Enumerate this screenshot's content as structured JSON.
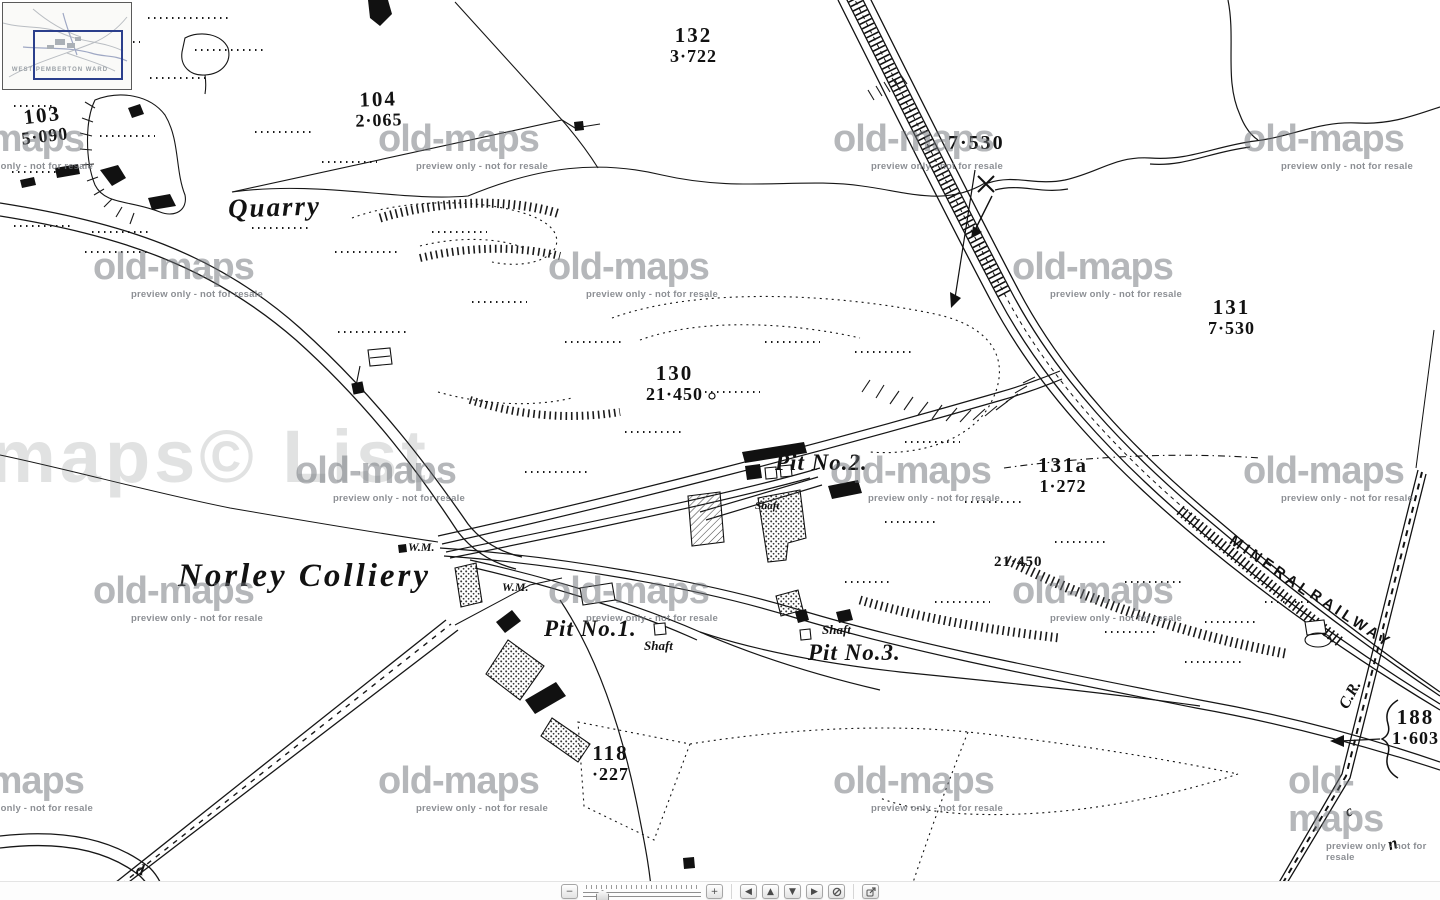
{
  "inset": {
    "caption": "WEST PEMBERTON WARD"
  },
  "watermarks": {
    "tile_text": "old-maps",
    "tile_caption": "preview only - not for resale",
    "giant_text": "maps© List"
  },
  "labels": {
    "quarry": "Quarry",
    "colliery": "Norley Colliery",
    "pit1": "Pit No.1.",
    "pit2": "Pit No.2.",
    "pit3": "Pit No.3.",
    "shaft": "Shaft",
    "wm": "W.M.",
    "mineral": "MINERAL",
    "railway": "RAILWAY",
    "cr": "C.R.",
    "rail_value": "7·530",
    "tip_value": "21·450",
    "letter_d": "d",
    "letter_c": "c",
    "letter_n": "n"
  },
  "parcels": [
    {
      "number": "132",
      "area": "3·722"
    },
    {
      "number": "104",
      "area": "2·065"
    },
    {
      "number": "103",
      "area": "5·090"
    },
    {
      "number": "131",
      "area": "7·530"
    },
    {
      "number": "130",
      "area": "21·450"
    },
    {
      "number": "131a",
      "area": "1·272"
    },
    {
      "number": "118",
      "area": "·227"
    },
    {
      "number": "188",
      "area": "1·603"
    }
  ],
  "toolbar": {
    "zoom_out": "−",
    "zoom_in": "+",
    "pan_left": "◀",
    "pan_up": "▲",
    "pan_down": "▼",
    "pan_right": "▶"
  }
}
